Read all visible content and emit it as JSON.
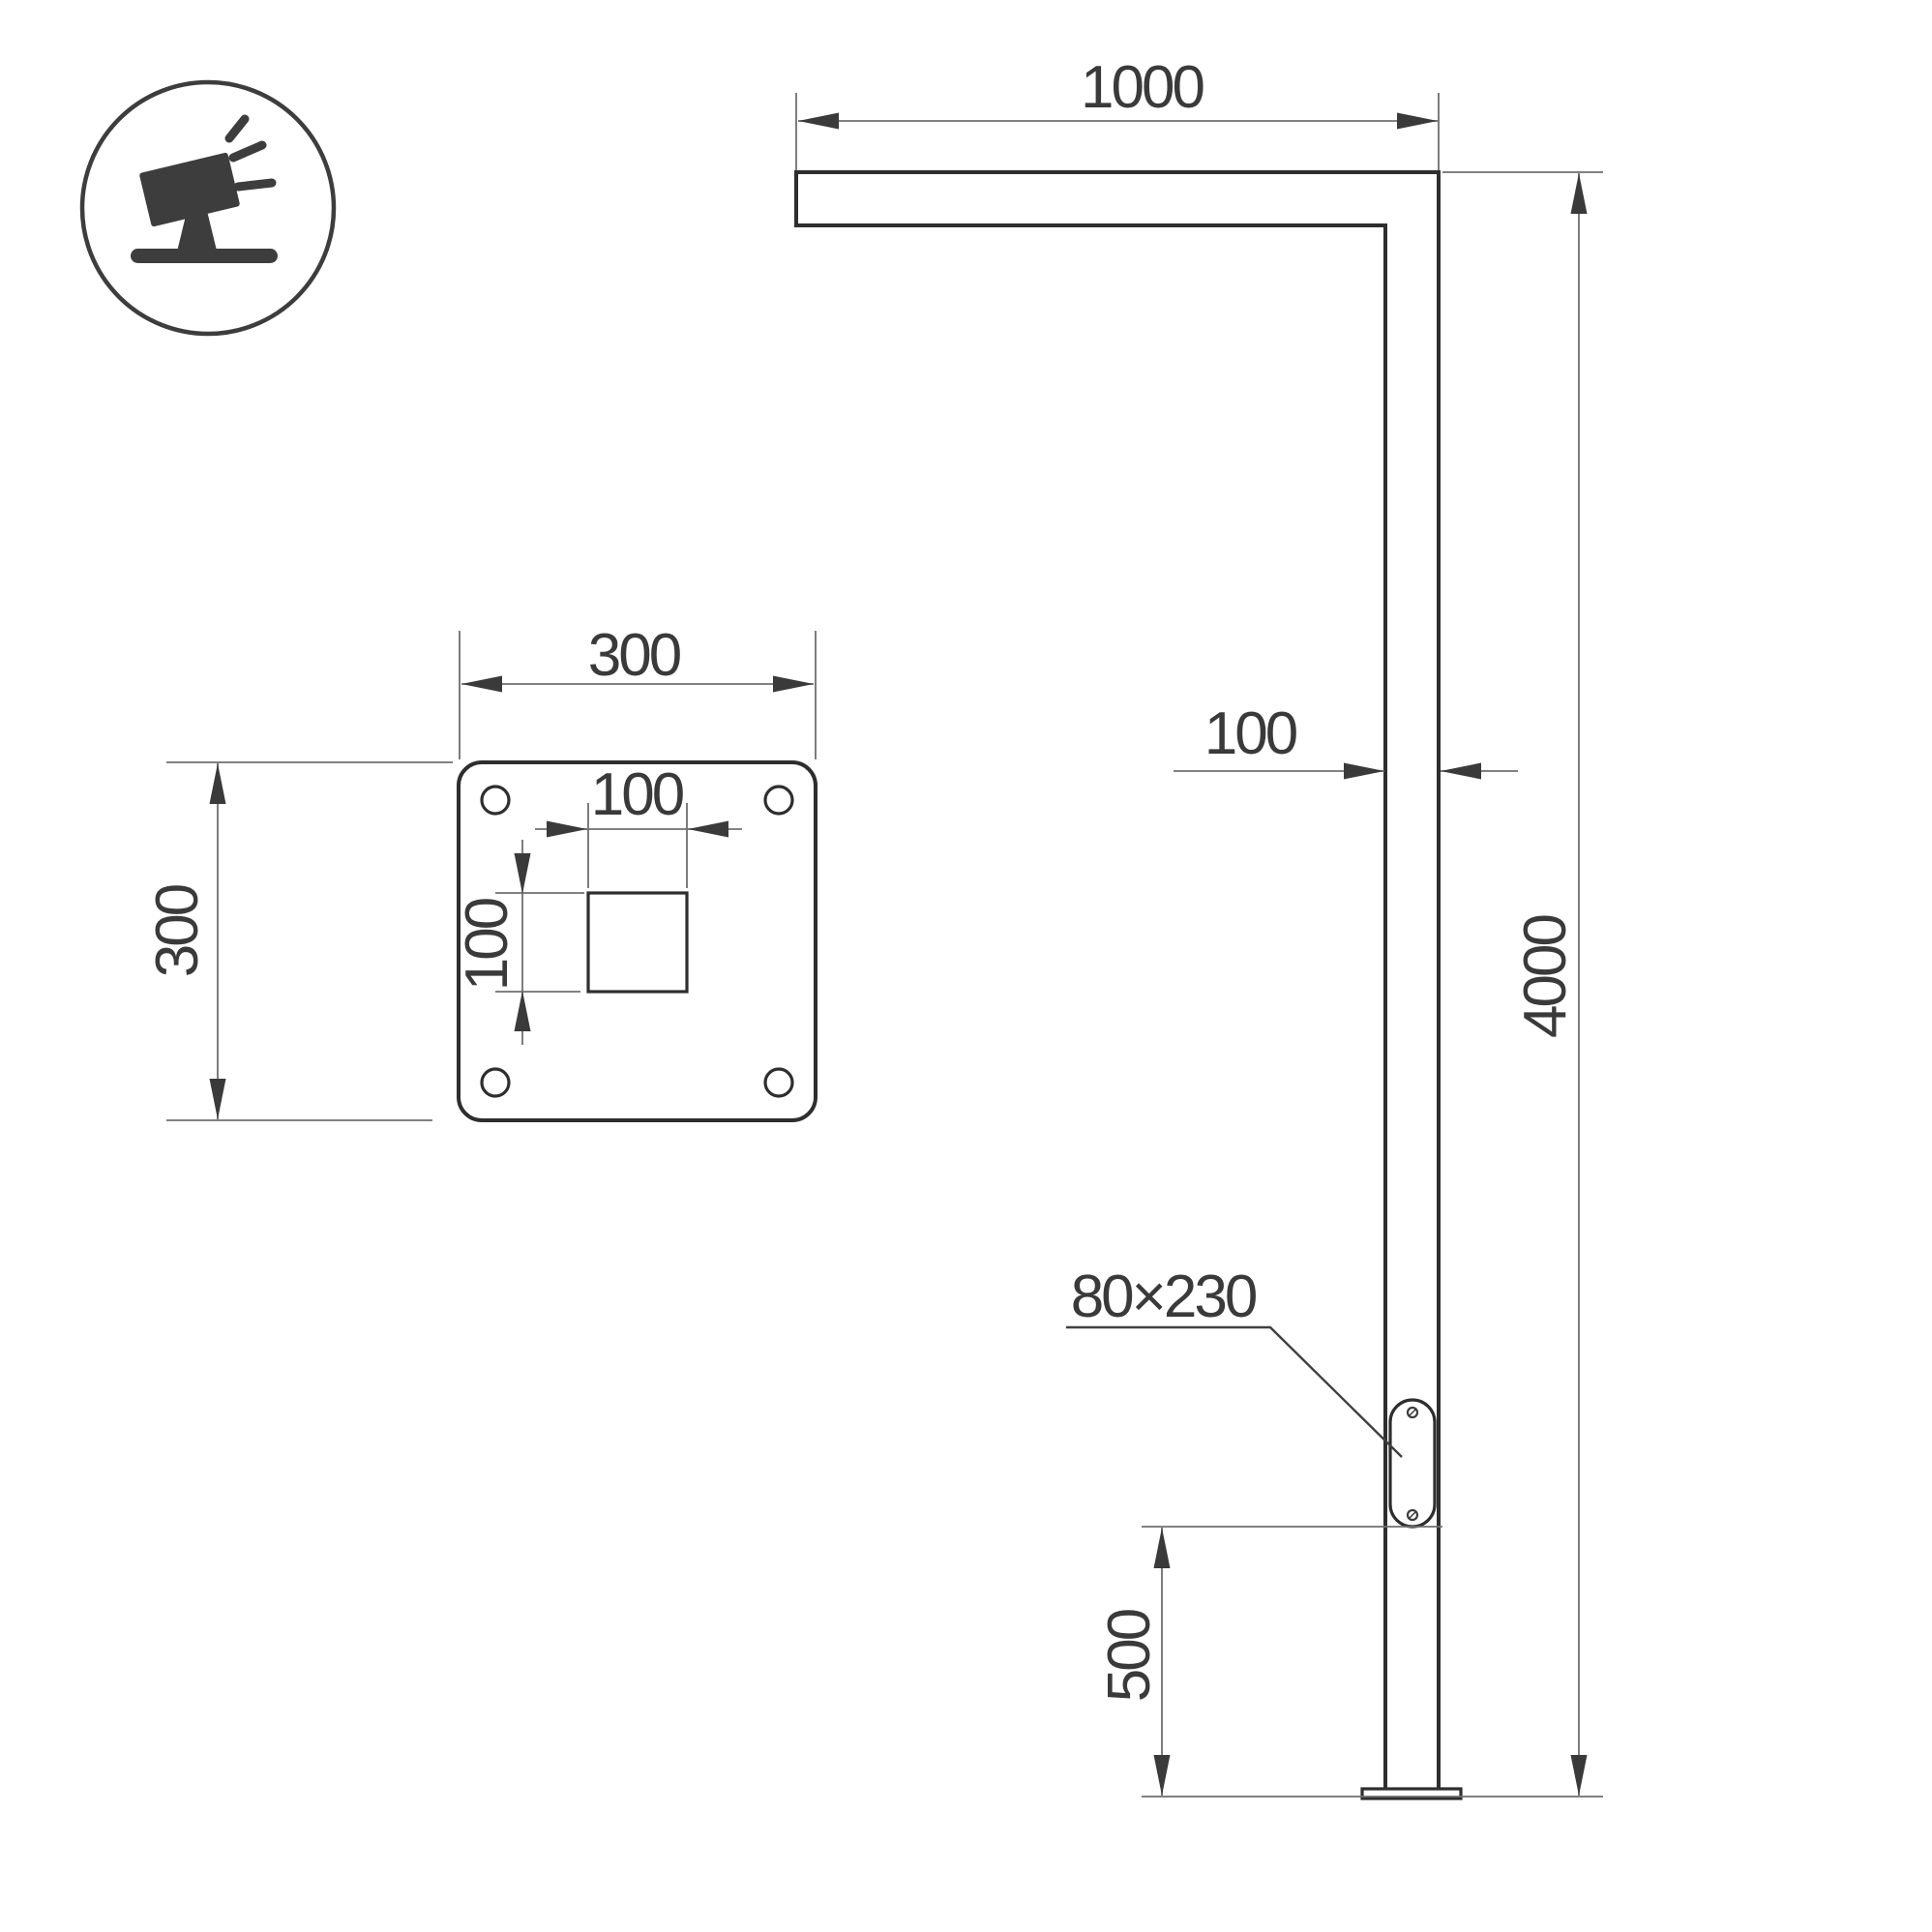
{
  "title": "street-light-pole-technical-drawing",
  "colors": {
    "background": "#ffffff",
    "outline": "#2e2e2e",
    "dimension_line": "#6f6f6f",
    "text": "#3a3a3a",
    "icon": "#3d3d3d"
  },
  "icon": {
    "label": "tilted-floodlight-luminaire"
  },
  "front_view": {
    "arm_length": "1000",
    "pole_width": "100",
    "total_height": "4000",
    "handhole_bottom_offset": "500",
    "handhole_size": "80×230"
  },
  "plate_view": {
    "plate_width": "300",
    "plate_height": "300",
    "hole_width": "100",
    "hole_height": "100"
  }
}
